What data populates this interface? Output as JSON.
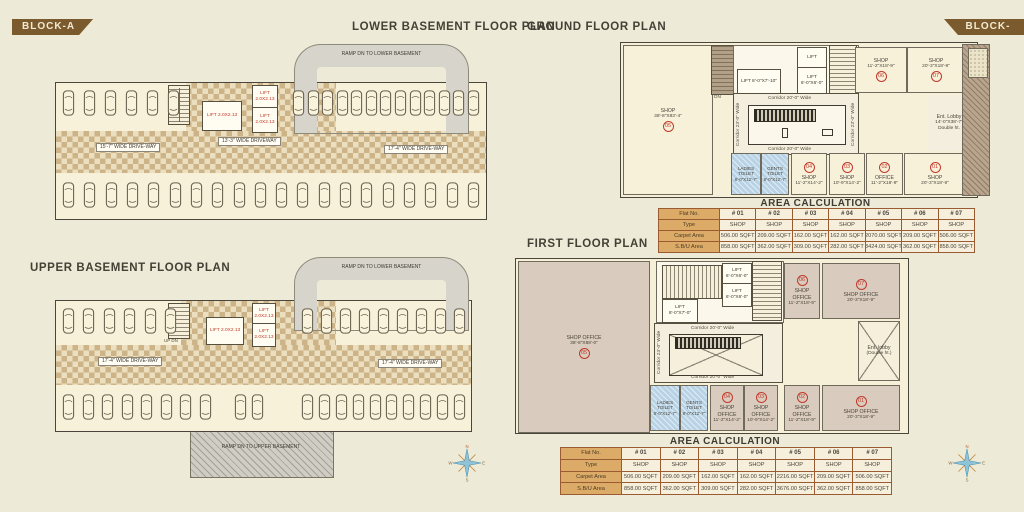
{
  "badge_left": "BLOCK-A",
  "badge_right": "BLOCK-A",
  "titles": {
    "lower": "LOWER BASEMENT FLOOR PLAN",
    "upper": "UPPER BASEMENT FLOOR PLAN",
    "ground": "GROUND FLOOR PLAN",
    "first": "FIRST FLOOR PLAN"
  },
  "lower_basement": {
    "ramp": "RAMP DN TO LOWER BASEMENT",
    "driveway_left": "15'-7\" WIDE DRIVE-WAY",
    "driveway_mid": "13'-3\" WIDE DRIVEWAY",
    "driveway_right": "17'-4\" WIDE DRIVE-WAY",
    "lift1": "LIFT 2.0X2.13",
    "lift2": "LIFT 2.0X2.13",
    "lift3": "LIFT 2.0X2.13"
  },
  "upper_basement": {
    "ramp_top": "RAMP DN TO LOWER BASEMENT",
    "ramp_bottom": "RAMP DN TO UPPER BASEMENT",
    "driveway_left": "17'-4\" WIDE DRIVE-WAY",
    "driveway_right": "17'-4\" WIDE DRIVE-WAY",
    "stair": "UP DN",
    "lift1": "LIFT 2.0X2.13",
    "lift2": "LIFT 2.0X2.13",
    "lift3": "LIFT 2.0X2.13"
  },
  "ground_floor": {
    "corridor_h": "Corridor 20'-0\" Wide",
    "corridor_v": "Corridor 23'-0\" Wide",
    "lift_a": "LIFT 8'-0\"X7'-10\"",
    "lift_b": "LIFT",
    "lift_c": "LIFT 6'-0\"X6'-0\"",
    "up": "UP",
    "dn": "DN",
    "rooms": {
      "shop05": {
        "name": "SHOP",
        "dims": "38'-8\"X83'-4\"",
        "no": "05"
      },
      "shop06": {
        "name": "SHOP",
        "dims": "11'-2\"X18'-9\"",
        "no": "06"
      },
      "shop07": {
        "name": "SHOP",
        "dims": "20'-3\"X18'-9\"",
        "no": "07"
      },
      "lobby": {
        "name": "Ent. Lobby",
        "dims": "14'-0\"X38'-7\"",
        "note": "Double ht."
      },
      "ladies": {
        "name": "LADIES TOILET",
        "dims": "8'-0\"X12'-7\""
      },
      "gents": {
        "name": "GENTS TOILET",
        "dims": "8'-0\"X12'-7\""
      },
      "shop04": {
        "name": "SHOP",
        "dims": "11'-2\"X14'-2\"",
        "no": "04"
      },
      "shop03": {
        "name": "SHOP",
        "dims": "10'-9\"X14'-2\"",
        "no": "03"
      },
      "office02": {
        "name": "OFFICE",
        "dims": "11'-2\"X18'-9\"",
        "no": "02"
      },
      "shop01": {
        "name": "SHOP",
        "dims": "20'-3\"X18'-9\"",
        "no": "01"
      }
    }
  },
  "first_floor": {
    "corridor_h": "Corridor 20'-0\" Wide",
    "corridor_v": "Corridor 23'-0\" Wide",
    "lift_a": "LIFT 8'-0\"X7'-0\"",
    "lift_b": "LIFT 6'-0\"X6'-0\"",
    "lift_c": "LIFT 6'-0\"X6'-0\"",
    "up": "UP",
    "dn": "DN",
    "rooms": {
      "so05": {
        "name": "SHOP OFFICE",
        "dims": "38'-8\"X88'-0\"",
        "no": "05"
      },
      "so06": {
        "name": "SHOP OFFICE",
        "dims": "11'-2\"X18'-9\"",
        "no": "06"
      },
      "so07": {
        "name": "SHOP OFFICE",
        "dims": "20'-3\"X18'-9\"",
        "no": "07"
      },
      "lobby": {
        "name": "Ent. lobby",
        "note": "(Double ht.)"
      },
      "ladies": {
        "name": "LADIES TOILET",
        "dims": "8'-0\"X12'-7\""
      },
      "gents": {
        "name": "GENTS TOILET",
        "dims": "8'-0\"X12'-7\""
      },
      "so04": {
        "name": "SHOP OFFICE",
        "dims": "11'-2\"X14'-2\"",
        "no": "04"
      },
      "so03": {
        "name": "SHOP OFFICE",
        "dims": "10'-9\"X14'-2\"",
        "no": "03"
      },
      "so02": {
        "name": "SHOP OFFICE",
        "dims": "11'-2\"X18'-9\"",
        "no": "02"
      },
      "so01": {
        "name": "SHOP OFFICE",
        "dims": "20'-3\"X18'-9\"",
        "no": "01"
      }
    }
  },
  "ground_table": {
    "title": "AREA CALCULATION",
    "rows": [
      [
        "Flat No.",
        "# 01",
        "# 02",
        "# 03",
        "# 04",
        "# 05",
        "# 06",
        "# 07"
      ],
      [
        "Type",
        "SHOP",
        "SHOP",
        "SHOP",
        "SHOP",
        "SHOP",
        "SHOP",
        "SHOP"
      ],
      [
        "Carpet Area",
        "506.00 SQFT",
        "209.00 SQFT",
        "162.00 SQFT",
        "162.00 SQFT",
        "2070.00 SQFT",
        "209.00 SQFT",
        "506.00 SQFT"
      ],
      [
        "S.B/U Area",
        "858.00 SQFT",
        "362.00 SQFT",
        "309.00 SQFT",
        "282.00 SQFT",
        "3424.00 SQFT",
        "362.00 SQFT",
        "858.00 SQFT"
      ]
    ]
  },
  "first_table": {
    "title": "AREA CALCULATION",
    "rows": [
      [
        "Flat No.",
        "# 01",
        "# 02",
        "# 03",
        "# 04",
        "# 05",
        "# 06",
        "# 07"
      ],
      [
        "Type",
        "SHOP",
        "SHOP",
        "SHOP",
        "SHOP",
        "SHOP",
        "SHOP",
        "SHOP"
      ],
      [
        "Carpet Area",
        "506.00 SQFT",
        "209.00 SQFT",
        "162.00 SQFT",
        "162.00 SQFT",
        "2216.00 SQFT",
        "209.00 SQFT",
        "506.00 SQFT"
      ],
      [
        "S.B/U Area",
        "858.00 SQFT",
        "362.00 SQFT",
        "309.00 SQFT",
        "282.00 SQFT",
        "3676.00 SQFT",
        "362.00 SQFT",
        "858.00 SQFT"
      ]
    ]
  },
  "compass": {
    "n": "N",
    "e": "E",
    "s": "S",
    "w": "W"
  },
  "colors": {
    "background": "#edebd7",
    "plan_fill": "#f8f1da",
    "taupe_fill": "#d9cbbd",
    "checker_tan": "#cdb488",
    "ramp_gray": "#d6d4cb",
    "badge_brown": "#7b5a2e",
    "table_label_bg": "#ddab68",
    "table_border": "#9a5b32",
    "accent_red": "#c0392b",
    "toilet_blue": "#b9d3e6",
    "compass_teal": "#8fc3d8"
  }
}
